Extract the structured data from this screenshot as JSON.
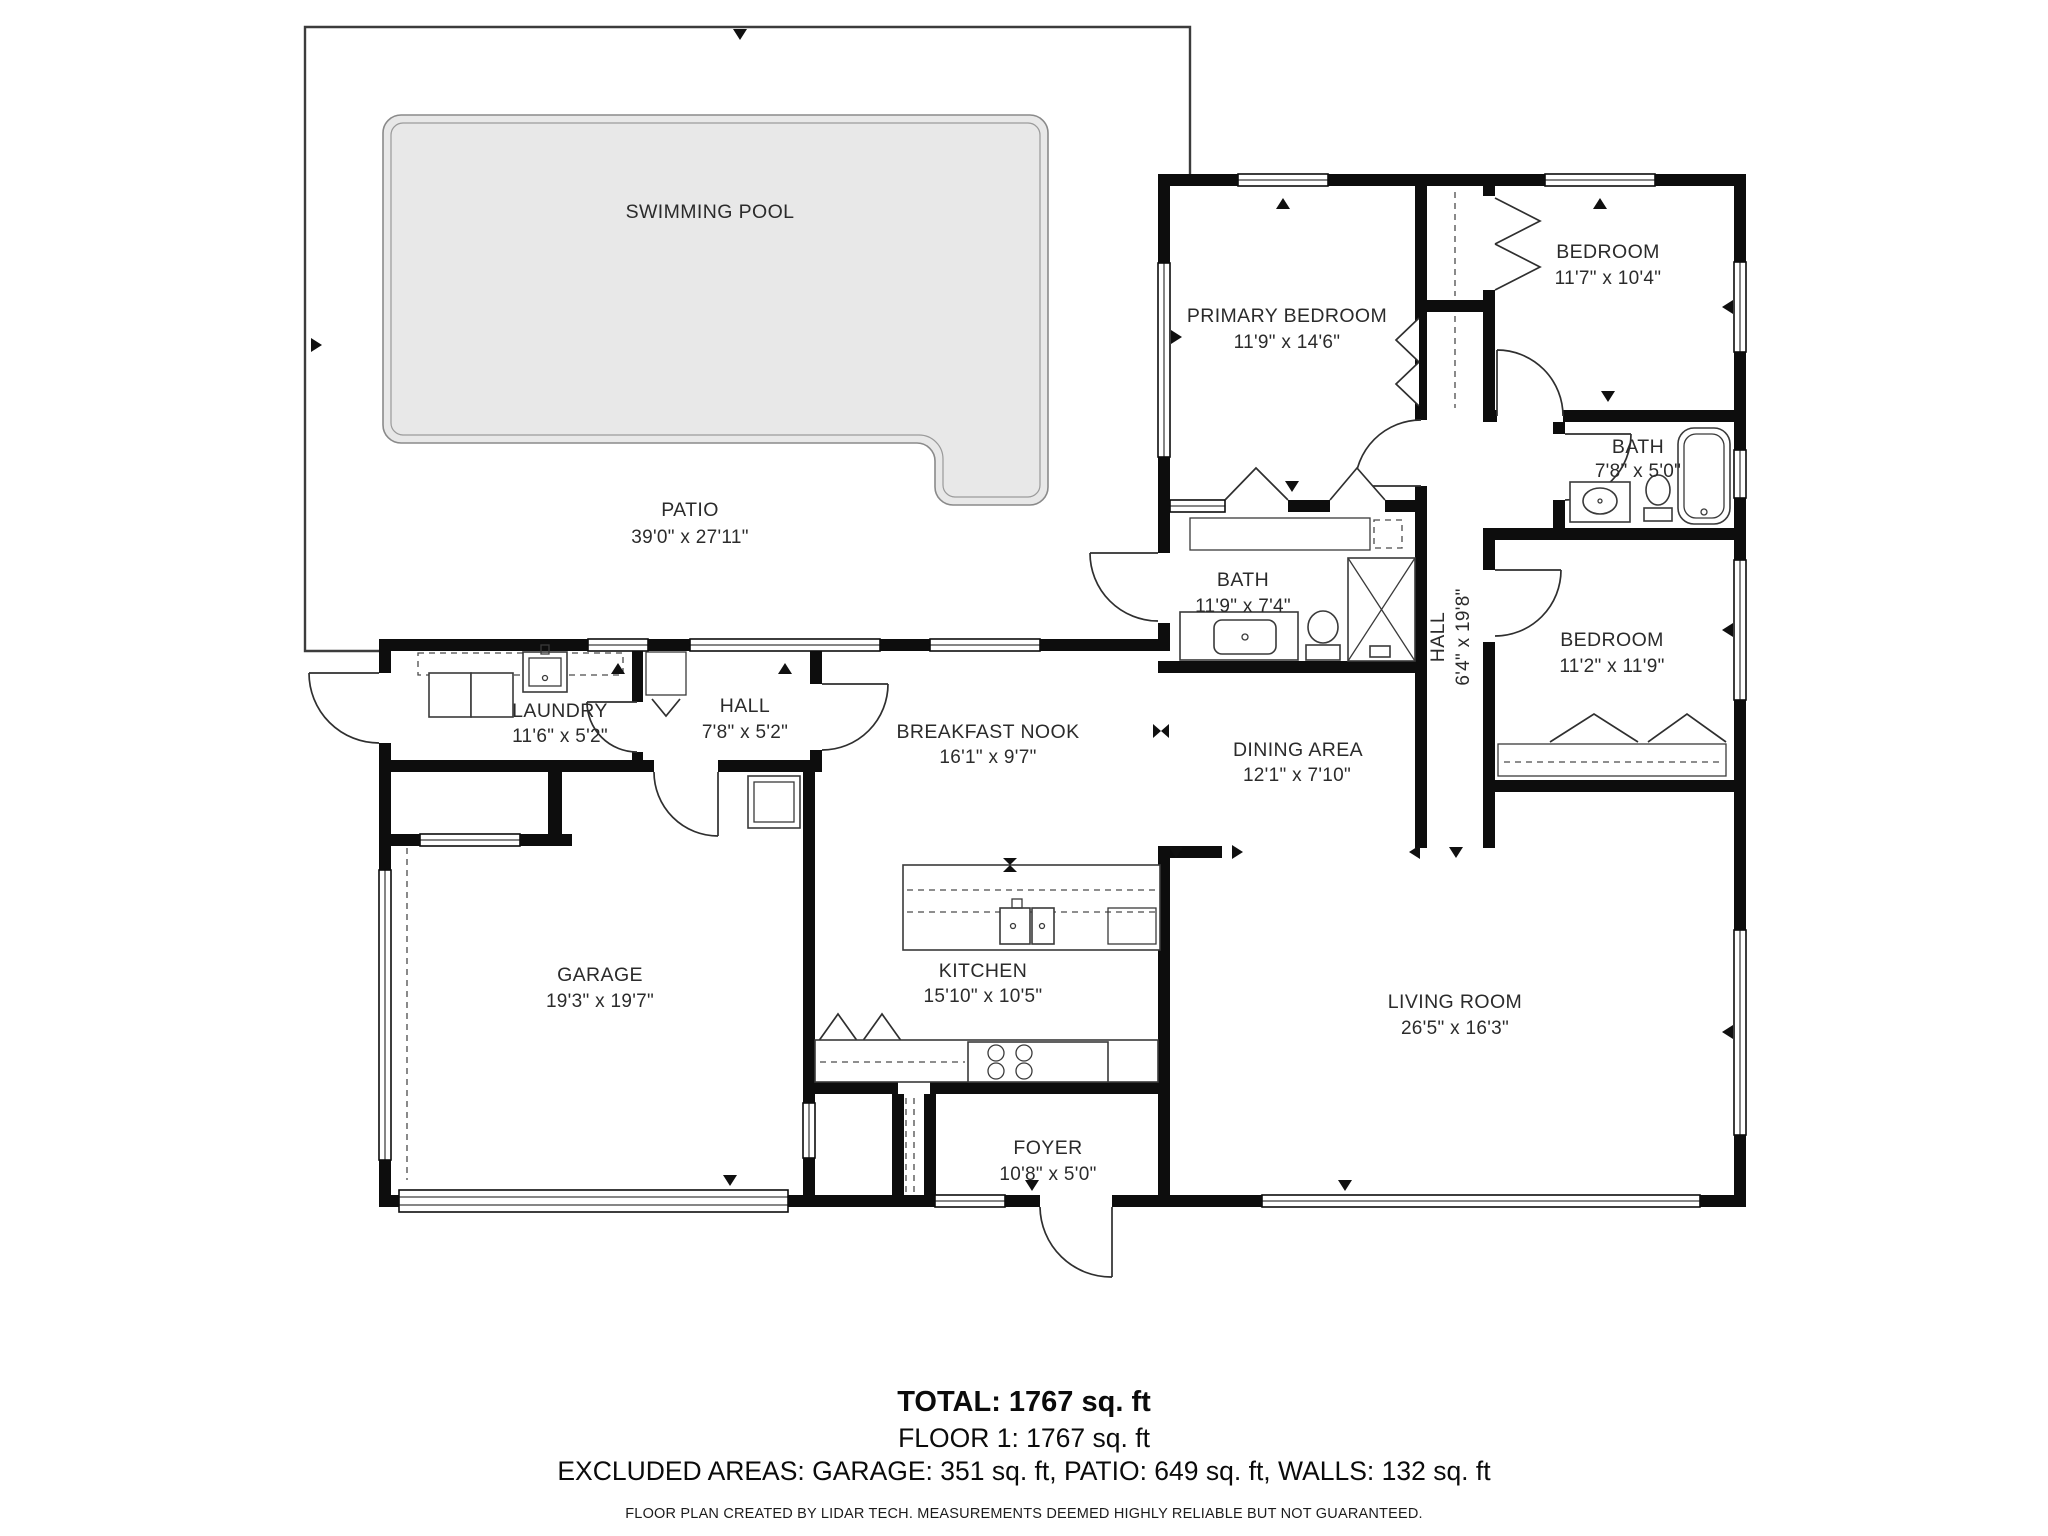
{
  "plan": {
    "rooms": [
      {
        "name": "SWIMMING POOL",
        "dims": ""
      },
      {
        "name": "PATIO",
        "dims": "39'0\" x 27'11\""
      },
      {
        "name": "PRIMARY BEDROOM",
        "dims": "11'9\" x 14'6\""
      },
      {
        "name": "BEDROOM",
        "dims": "11'7\" x 10'4\""
      },
      {
        "name": "BATH",
        "dims": "7'8\" x 5'0\""
      },
      {
        "name": "BATH",
        "dims": "11'9\" x 7'4\""
      },
      {
        "name": "HALL",
        "dims": "6'4\" x 19'8\""
      },
      {
        "name": "BEDROOM",
        "dims": "11'2\" x 11'9\""
      },
      {
        "name": "LAUNDRY",
        "dims": "11'6\" x 5'2\""
      },
      {
        "name": "HALL",
        "dims": "7'8\" x 5'2\""
      },
      {
        "name": "BREAKFAST NOOK",
        "dims": "16'1\" x 9'7\""
      },
      {
        "name": "DINING AREA",
        "dims": "12'1\" x 7'10\""
      },
      {
        "name": "GARAGE",
        "dims": "19'3\" x 19'7\""
      },
      {
        "name": "KITCHEN",
        "dims": "15'10\" x 10'5\""
      },
      {
        "name": "LIVING ROOM",
        "dims": "26'5\" x 16'3\""
      },
      {
        "name": "FOYER",
        "dims": "10'8\" x 5'0\""
      }
    ],
    "summary": {
      "total": "TOTAL: 1767 sq. ft",
      "floor": "FLOOR 1: 1767 sq. ft",
      "excluded": "EXCLUDED AREAS: GARAGE: 351 sq. ft, PATIO: 649 sq. ft, WALLS: 132 sq. ft",
      "disclaimer": "FLOOR PLAN CREATED BY LIDAR TECH. MEASUREMENTS DEEMED HIGHLY RELIABLE BUT NOT GUARANTEED."
    }
  }
}
